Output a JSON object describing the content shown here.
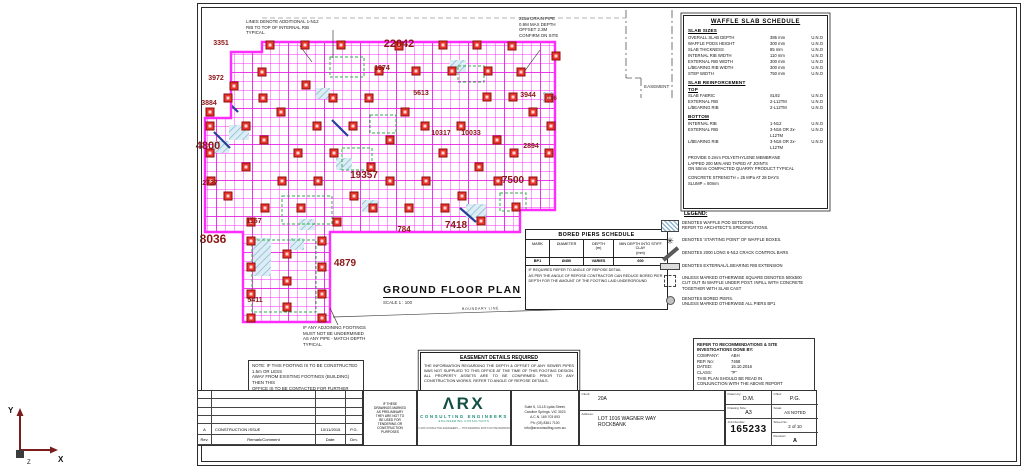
{
  "colors": {
    "grid": "#ff2bff",
    "grid_heavy": "#e316e3",
    "pod_fill": "#e7342c",
    "pod_edge": "#8f0f0f",
    "dim": "#8b1616",
    "hatch": "#7fb7cf",
    "hatch_bg": "#dcedf5",
    "green": "#2fae4a",
    "crack_bar": "#27409a",
    "teal": "#1b8a74"
  },
  "plan_title": {
    "title": "GROUND FLOOR PLAN",
    "scale": "SCALE 1 : 100"
  },
  "notes": {
    "top_note": "LINES DENOTE ADDITIONAL 1-N12\nRIB TO TOP OF INTERNAL RIB\nTYPICAL.",
    "drain_note": "225ø DRAIN PIPE\n0.9M MAX DEPTH\nOFFSET 2.3M\nCONFIRM ON SITE",
    "adjoin_note": "IF ANY ADJOINING FOOTINGS\nMUST NOT BE UNDERMINED\nAS ANY PIPE - MATCH DEPTH\nTYPICAL.",
    "left_note": "NOTE: IF THIS FOOTING IS TO BE CONSTRUCTED 1.5m OR LESS\nAWAY FROM EXISTING FOOTINGS (BUILDING) THEN THIS\nOFFICE IS TO BE CONTACTED FOR FURTHER ADVICE",
    "easement_label": "EASEMENT",
    "boundary_label": "BOUNDARY LINE"
  },
  "waffle": {
    "title": "WAFFLE SLAB SCHEDULE",
    "sizes_title": "SLAB SIZES",
    "slab_sizes": [
      {
        "label": "OVERALL SLAB DEPTH",
        "value": "385 mm",
        "note": "U.N.O"
      },
      {
        "label": "WAFFLE PODS HEIGHT",
        "value": "300 mm",
        "note": "U.N.O"
      },
      {
        "label": "SLAB THICKNESS",
        "value": "85 mm",
        "note": "U.N.O"
      },
      {
        "label": "INTERNAL RIB WIDTH",
        "value": "110 mm",
        "note": "U.N.O"
      },
      {
        "label": "EXTERNAL RIB WIDTH",
        "value": "300 mm",
        "note": "U.N.O"
      },
      {
        "label": "L/BEARING RIB WIDTH",
        "value": "300 mm",
        "note": "U.N.O"
      },
      {
        "label": "STEP WIDTH",
        "value": "750 mm",
        "note": "U.N.O"
      }
    ],
    "reinf_title": "SLAB REINFORCEMENT",
    "top_title": "TOP",
    "top": [
      {
        "label": "SLAB FABRIC",
        "value": "SL92",
        "note": "U.N.O"
      },
      {
        "label": "EXTERNAL RIB",
        "value": "2-L12TM",
        "note": "U.N.O"
      },
      {
        "label": "L/BEARING RIB",
        "value": "2-L12TM",
        "note": "U.N.O"
      }
    ],
    "bottom_title": "BOTTOM",
    "bottom": [
      {
        "label": "INTERNAL RIB",
        "value": "1-N12",
        "note": "U.N.O"
      },
      {
        "label": "EXTERNAL RIB",
        "value": "3-N16 OR 2x-L12TM",
        "note": "U.N.O"
      },
      {
        "label": "L/BEARING RIB",
        "value": "3-N16 OR 2x-L12TM",
        "note": "U.N.O"
      }
    ],
    "notes": [
      "PROVIDE 0.2mm POLYETHYLENE MEMBRANE\nLAPPED 200 MIN AND TAPED AT JOINTS\nON 50mm COMPACTED QUARRY PRODUCT TYPICAL",
      "CONCRETE STRENGTH = 25 MPa AT 28 DAYS\nSLUMP = 80mm"
    ]
  },
  "legend": {
    "title": "LEGEND:",
    "items": [
      {
        "icon": "waffle-pod-setdown-icon",
        "cls": "ic-hatch",
        "text": "DENOTES WAFFLE POD SETDOWN.\nREFER TO ARCHITECT'S SPECIFICATIONS."
      },
      {
        "icon": "starting-point-icon",
        "cls": "ic-star",
        "glyph": "✳",
        "text": "DENOTES 'STARTING POINT' OF WAFFLE BOXES."
      },
      {
        "icon": "crack-control-bar-icon",
        "cls": "ic-bar",
        "text": "DENOTES 2000 LONG 6-N12 CRACK CONTROL BARS"
      },
      {
        "icon": "rib-extension-icon",
        "cls": "ic-ribext",
        "text": "DENOTES EXTERNAL/L.BEARING RIB EXTENSION"
      },
      {
        "icon": "cutout-square-icon",
        "cls": "ic-cutout",
        "text": "UNLESS MARKED OTHERWISE SQUARE DENOTES 500x500\nCUT OUT IN WAFFLE UNDER POST. INFILL WITH CONCRETE\nTOGETHER WITH SLAB CAST"
      },
      {
        "icon": "bored-pier-icon",
        "cls": "ic-pier",
        "text": "DENOTES BORED PIERS.\nUNLESS MARKED OTHERWISE ALL PIERS BP1"
      }
    ]
  },
  "geo_box": {
    "title": "REFER TO RECOMMENDATIONS & SITE\nINVESTIGATIONS DONE BY:",
    "rows": [
      {
        "label": "COMPANY:",
        "value": "ABH"
      },
      {
        "label": "REP. No:",
        "value": "7468"
      },
      {
        "label": "DATED:",
        "value": "15.10.2016"
      },
      {
        "label": "CLASS:",
        "value": "\"P\""
      }
    ],
    "footer": "THIS PLAN SHOULD BE READ IN\nCONJUNCTION WITH THE ABOVE REPORT"
  },
  "bored_piers": {
    "title": "BORED PIERS SCHEDULE",
    "headers": [
      "MARK",
      "DIAMETER",
      "DEPTH\n(m)",
      "MIN DEPTH INTO STIFF\nCLAY\n(mm)"
    ],
    "row": [
      "BP1",
      "Ø450",
      "VARIES",
      "600"
    ],
    "notes": [
      "IF REQUIRED REFER TO ANGLE OF REPOSE DETAIL",
      "AS PER THE ANGLE OF REPOSE CONTRACTOR CAN REDUCE BORED PIER DEPTH FOR THE AMOUNT OF THE FOOTING LAID UNDERGROUND"
    ]
  },
  "easement_box": {
    "title": "EASEMENT DETAILS REQUIRED",
    "body": "THE INFORMATION REGARDING THE DEPTH & OFFSET OF ANY SEWER PIPES WAS NOT SUPPLIED TO THIS OFFICE AT THE TIME OF THIS FOOTING DESIGN. ALL PROPERTY ASSETS ARE TO BE CONFIRMED PRIOR TO ANY CONSTRUCTION WORKS. REFER TO ANGLE OF REPOSE DETAILS."
  },
  "titleblock": {
    "rev_row": {
      "rev": "A",
      "comment": "CONSTRUCTION ISSUE",
      "date": "10/11/2015",
      "drn": "P.G."
    },
    "rev_headers": {
      "rev": "Rev.",
      "comment": "Remark/Comment",
      "date": "Date:",
      "drn": "Drn."
    },
    "disclaimer": "IF THESE\nDRAWINGS MARKED\nAS PRELIMINARY\nTHEY ARE NOT TO\nBE USED FOR\nTENDERING OR\nCONSTRUCTION\nPURPOSES",
    "logo": {
      "main": "ΛRX",
      "sub": "CONSULTING ENGINEERS",
      "tag": "ENGINEERING CONSULTANTS",
      "copyright": "© ARX CONSULTING ENGINEERS — THIS DRAWING MUST NOT BE REPRODUCED WITHOUT WRITTEN PERMISSION"
    },
    "address_lines": "Suite 5, 13-15 Lydia Street,\nCaroline Springs, VIC 3023\nA.C.N. 169 703 693\nPh: (03) 8361 7100\ninfo@arxconsulting.com.au",
    "client_label": "Client:",
    "client": "20A",
    "site_label": "Address:",
    "site": "LOT 1016 WAGNER WAY\nROCKBANK",
    "drawn_label": "Drawn by:",
    "drawn": "D.M.",
    "chkd_label": "Chkd:",
    "chkd": "P.G.",
    "size_label": "Drawing Size:",
    "size": "A3",
    "scale_label": "Scale:",
    "scale": "AS NOTED",
    "job_label": "Job Number:",
    "job": "165233",
    "sheet_label": "Sheet No.:",
    "sheet": "2 of 10",
    "rev_label": "Revision:",
    "rev": "A"
  },
  "ucs": {
    "x": "X",
    "y": "Y",
    "z": "Z"
  },
  "plan": {
    "outline": "231,52 262,52 262,42 555,42 555,210 520,210 520,232 330,232 330,322 243,322 243,232 205,232 205,118 231,118",
    "squares": [
      [
        270,
        45
      ],
      [
        305,
        45
      ],
      [
        341,
        45
      ],
      [
        399,
        46
      ],
      [
        443,
        45
      ],
      [
        477,
        45
      ],
      [
        512,
        46
      ],
      [
        556,
        56
      ],
      [
        262,
        72
      ],
      [
        379,
        71
      ],
      [
        416,
        71
      ],
      [
        452,
        71
      ],
      [
        488,
        71
      ],
      [
        521,
        72
      ],
      [
        234,
        86
      ],
      [
        306,
        85
      ],
      [
        228,
        98
      ],
      [
        263,
        98
      ],
      [
        333,
        98
      ],
      [
        369,
        98
      ],
      [
        487,
        97
      ],
      [
        513,
        97
      ],
      [
        549,
        98
      ],
      [
        210,
        112
      ],
      [
        281,
        112
      ],
      [
        405,
        112
      ],
      [
        533,
        112
      ],
      [
        210,
        126
      ],
      [
        246,
        126
      ],
      [
        317,
        126
      ],
      [
        353,
        126
      ],
      [
        425,
        126
      ],
      [
        461,
        126
      ],
      [
        551,
        126
      ],
      [
        264,
        140
      ],
      [
        390,
        140
      ],
      [
        497,
        140
      ],
      [
        210,
        153
      ],
      [
        298,
        153
      ],
      [
        334,
        153
      ],
      [
        443,
        153
      ],
      [
        514,
        153
      ],
      [
        549,
        153
      ],
      [
        246,
        167
      ],
      [
        371,
        167
      ],
      [
        479,
        167
      ],
      [
        211,
        181
      ],
      [
        282,
        181
      ],
      [
        318,
        181
      ],
      [
        390,
        181
      ],
      [
        426,
        181
      ],
      [
        498,
        181
      ],
      [
        533,
        181
      ],
      [
        228,
        196
      ],
      [
        354,
        196
      ],
      [
        462,
        196
      ],
      [
        265,
        208
      ],
      [
        301,
        208
      ],
      [
        373,
        208
      ],
      [
        409,
        208
      ],
      [
        445,
        208
      ],
      [
        516,
        207
      ],
      [
        251,
        222
      ],
      [
        337,
        222
      ],
      [
        481,
        221
      ],
      [
        251,
        241
      ],
      [
        322,
        241
      ],
      [
        287,
        254
      ],
      [
        251,
        267
      ],
      [
        322,
        267
      ],
      [
        287,
        281
      ],
      [
        251,
        294
      ],
      [
        322,
        294
      ],
      [
        287,
        307
      ],
      [
        251,
        318
      ],
      [
        322,
        318
      ]
    ],
    "dims": [
      [
        "3351",
        221,
        45,
        7
      ],
      [
        "3972",
        216,
        80,
        7
      ],
      [
        "3884",
        209,
        105,
        7
      ],
      [
        "4800",
        208,
        149,
        11
      ],
      [
        "2737",
        210,
        185,
        7
      ],
      [
        "8036",
        213,
        243,
        12
      ],
      [
        "1157",
        254,
        223,
        7
      ],
      [
        "5411",
        255,
        302,
        7
      ],
      [
        "22042",
        399,
        47,
        11
      ],
      [
        "1974",
        382,
        70,
        7
      ],
      [
        "5613",
        421,
        95,
        7
      ],
      [
        "3944",
        528,
        97,
        7
      ],
      [
        "116",
        552,
        100,
        6
      ],
      [
        "10317",
        441,
        135,
        7
      ],
      [
        "10033",
        471,
        135,
        7
      ],
      [
        "19357",
        364,
        178,
        10
      ],
      [
        "7500",
        513,
        183,
        10
      ],
      [
        "2894",
        531,
        148,
        7
      ],
      [
        "784",
        404,
        232,
        8
      ],
      [
        "7418",
        456,
        228,
        10
      ],
      [
        "4879",
        345,
        266,
        10
      ]
    ],
    "hatches": [
      [
        213,
        104,
        18,
        13
      ],
      [
        229,
        125,
        20,
        15
      ],
      [
        213,
        141,
        16,
        12
      ],
      [
        299,
        219,
        16,
        11
      ],
      [
        466,
        204,
        20,
        14
      ],
      [
        336,
        158,
        16,
        12
      ],
      [
        543,
        92,
        14,
        11
      ],
      [
        253,
        238,
        18,
        38
      ],
      [
        290,
        238,
        14,
        12
      ],
      [
        450,
        60,
        16,
        12
      ],
      [
        316,
        88,
        14,
        11
      ],
      [
        362,
        200,
        16,
        12
      ]
    ],
    "green_boxes": [
      [
        330,
        57,
        34,
        20
      ],
      [
        458,
        66,
        26,
        16
      ],
      [
        282,
        196,
        50,
        28
      ],
      [
        342,
        148,
        30,
        22
      ],
      [
        500,
        193,
        26,
        18
      ],
      [
        252,
        240,
        64,
        72
      ],
      [
        370,
        115,
        26,
        18
      ]
    ],
    "bars": [
      [
        222,
        96,
        238,
        112
      ],
      [
        214,
        132,
        230,
        148
      ],
      [
        460,
        208,
        476,
        222
      ],
      [
        332,
        120,
        348,
        136
      ]
    ],
    "leaders": [
      [
        300,
        46,
        312,
        62
      ],
      [
        540,
        50,
        524,
        72
      ],
      [
        338,
        325,
        330,
        308
      ],
      [
        333,
        30,
        333,
        58
      ]
    ],
    "easement_lines": [
      [
        626,
        10,
        626,
        78
      ],
      [
        641,
        78,
        641,
        98
      ],
      [
        672,
        10,
        672,
        98
      ]
    ],
    "easement_step": [
      626,
      78,
      641,
      78
    ],
    "top_dash": [
      262,
      18,
      626,
      18
    ],
    "boundary_line": [
      333,
      317,
      612,
      308
    ],
    "easement_label_xy": [
      644,
      88
    ],
    "boundary_label_xy": [
      462,
      310
    ]
  }
}
